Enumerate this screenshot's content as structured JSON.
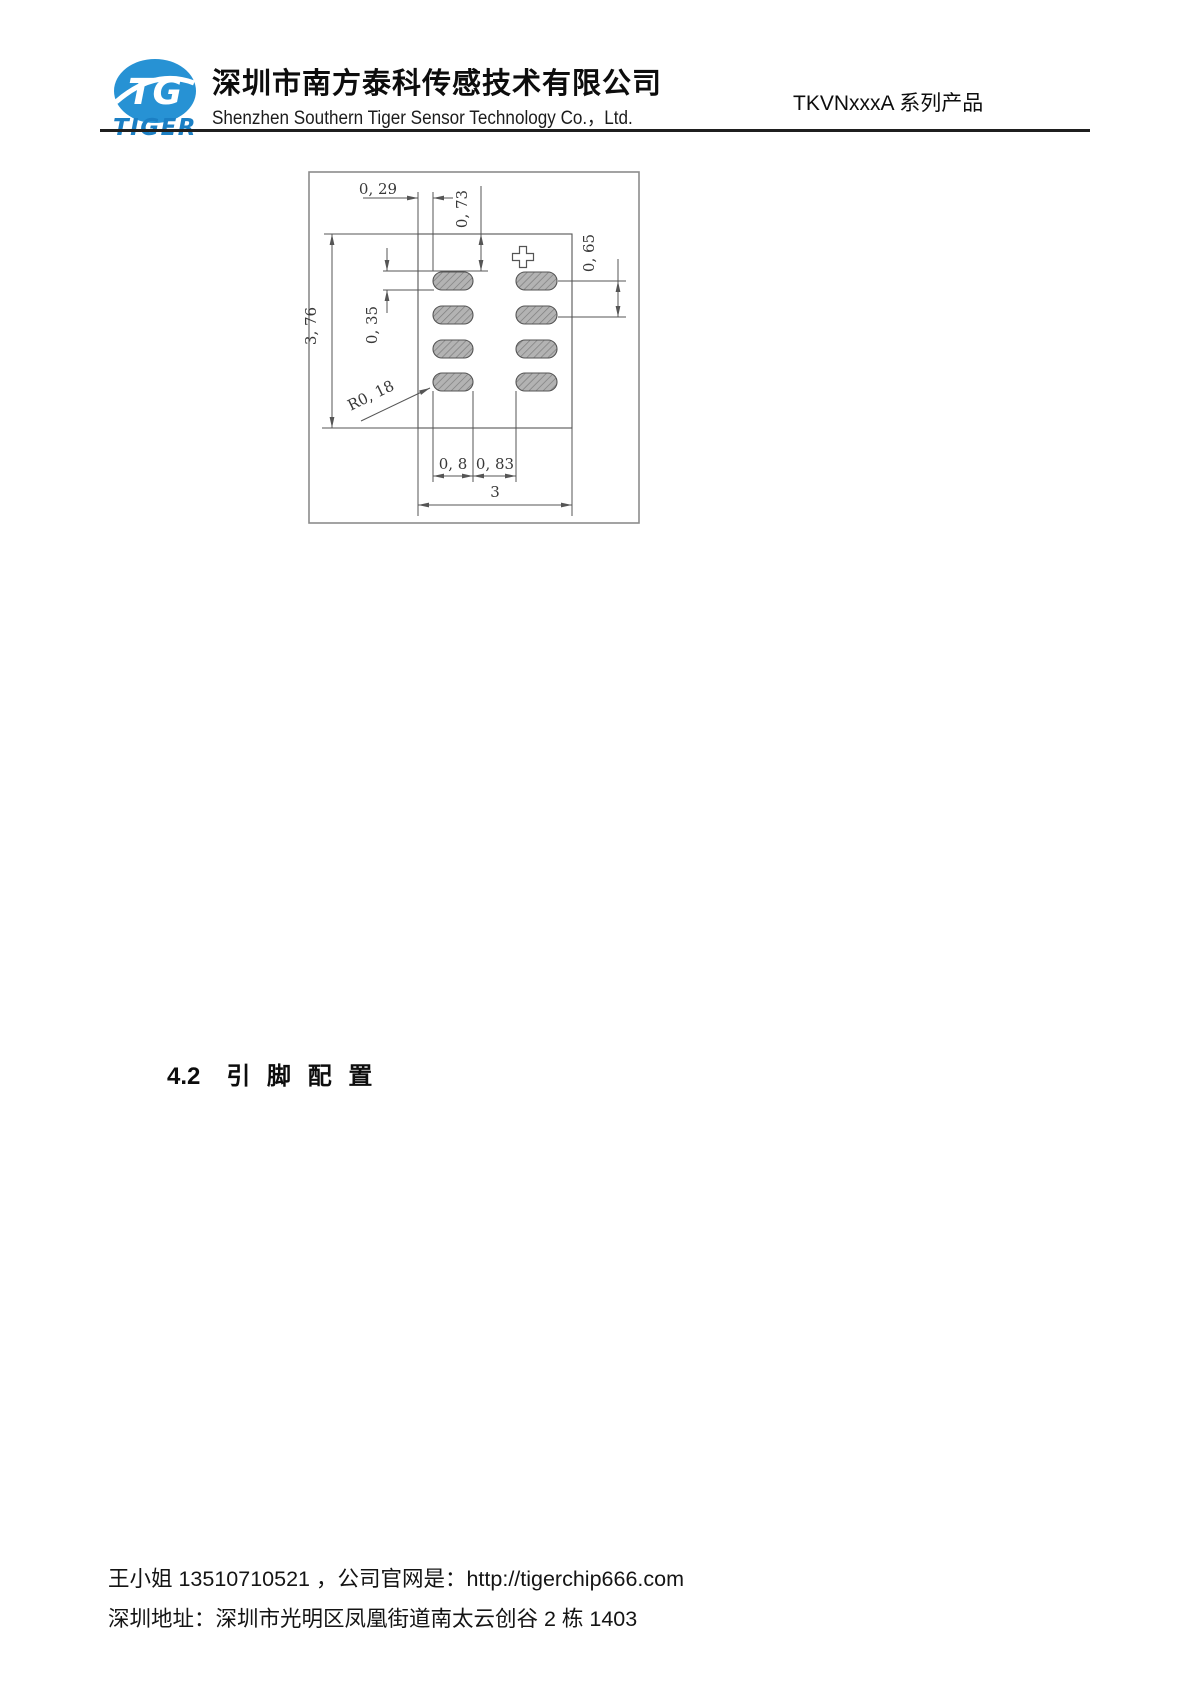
{
  "header": {
    "logo": {
      "monogram": "TG",
      "brand": "TIGER"
    },
    "company_cn": "深圳市南方泰科传感技术有限公司",
    "company_en": "Shenzhen Southern Tiger Sensor Technology Co.，Ltd.",
    "product_series": "TKVNxxxA 系列产品"
  },
  "drawing": {
    "description": "recommended solder pad land pattern, 8 hatched pads in 2 columns",
    "dims": {
      "d029": "0, 29",
      "d073": "0, 73",
      "d065": "0, 65",
      "d376": "3, 76",
      "d035": "0, 35",
      "r018": "R0, 18",
      "d08": "0, 8",
      "d083": "0, 83",
      "d3": "3"
    }
  },
  "section": {
    "number": "4.2",
    "title": "引 脚 配 置"
  },
  "footer": {
    "line1": "王小姐 13510710521 ，公司官网是：http://tigerchip666.com",
    "line2": "深圳地址：深圳市光明区凤凰街道南太云创谷 2 栋 1403"
  },
  "colors": {
    "brand_blue": "#2792d4",
    "drawing_line": "#555555",
    "frame_gray": "#8c8c8c",
    "pad_fill": "#b3b3b3",
    "pad_hatch": "#7d7d7d",
    "rule_black": "#1f1f1f"
  }
}
